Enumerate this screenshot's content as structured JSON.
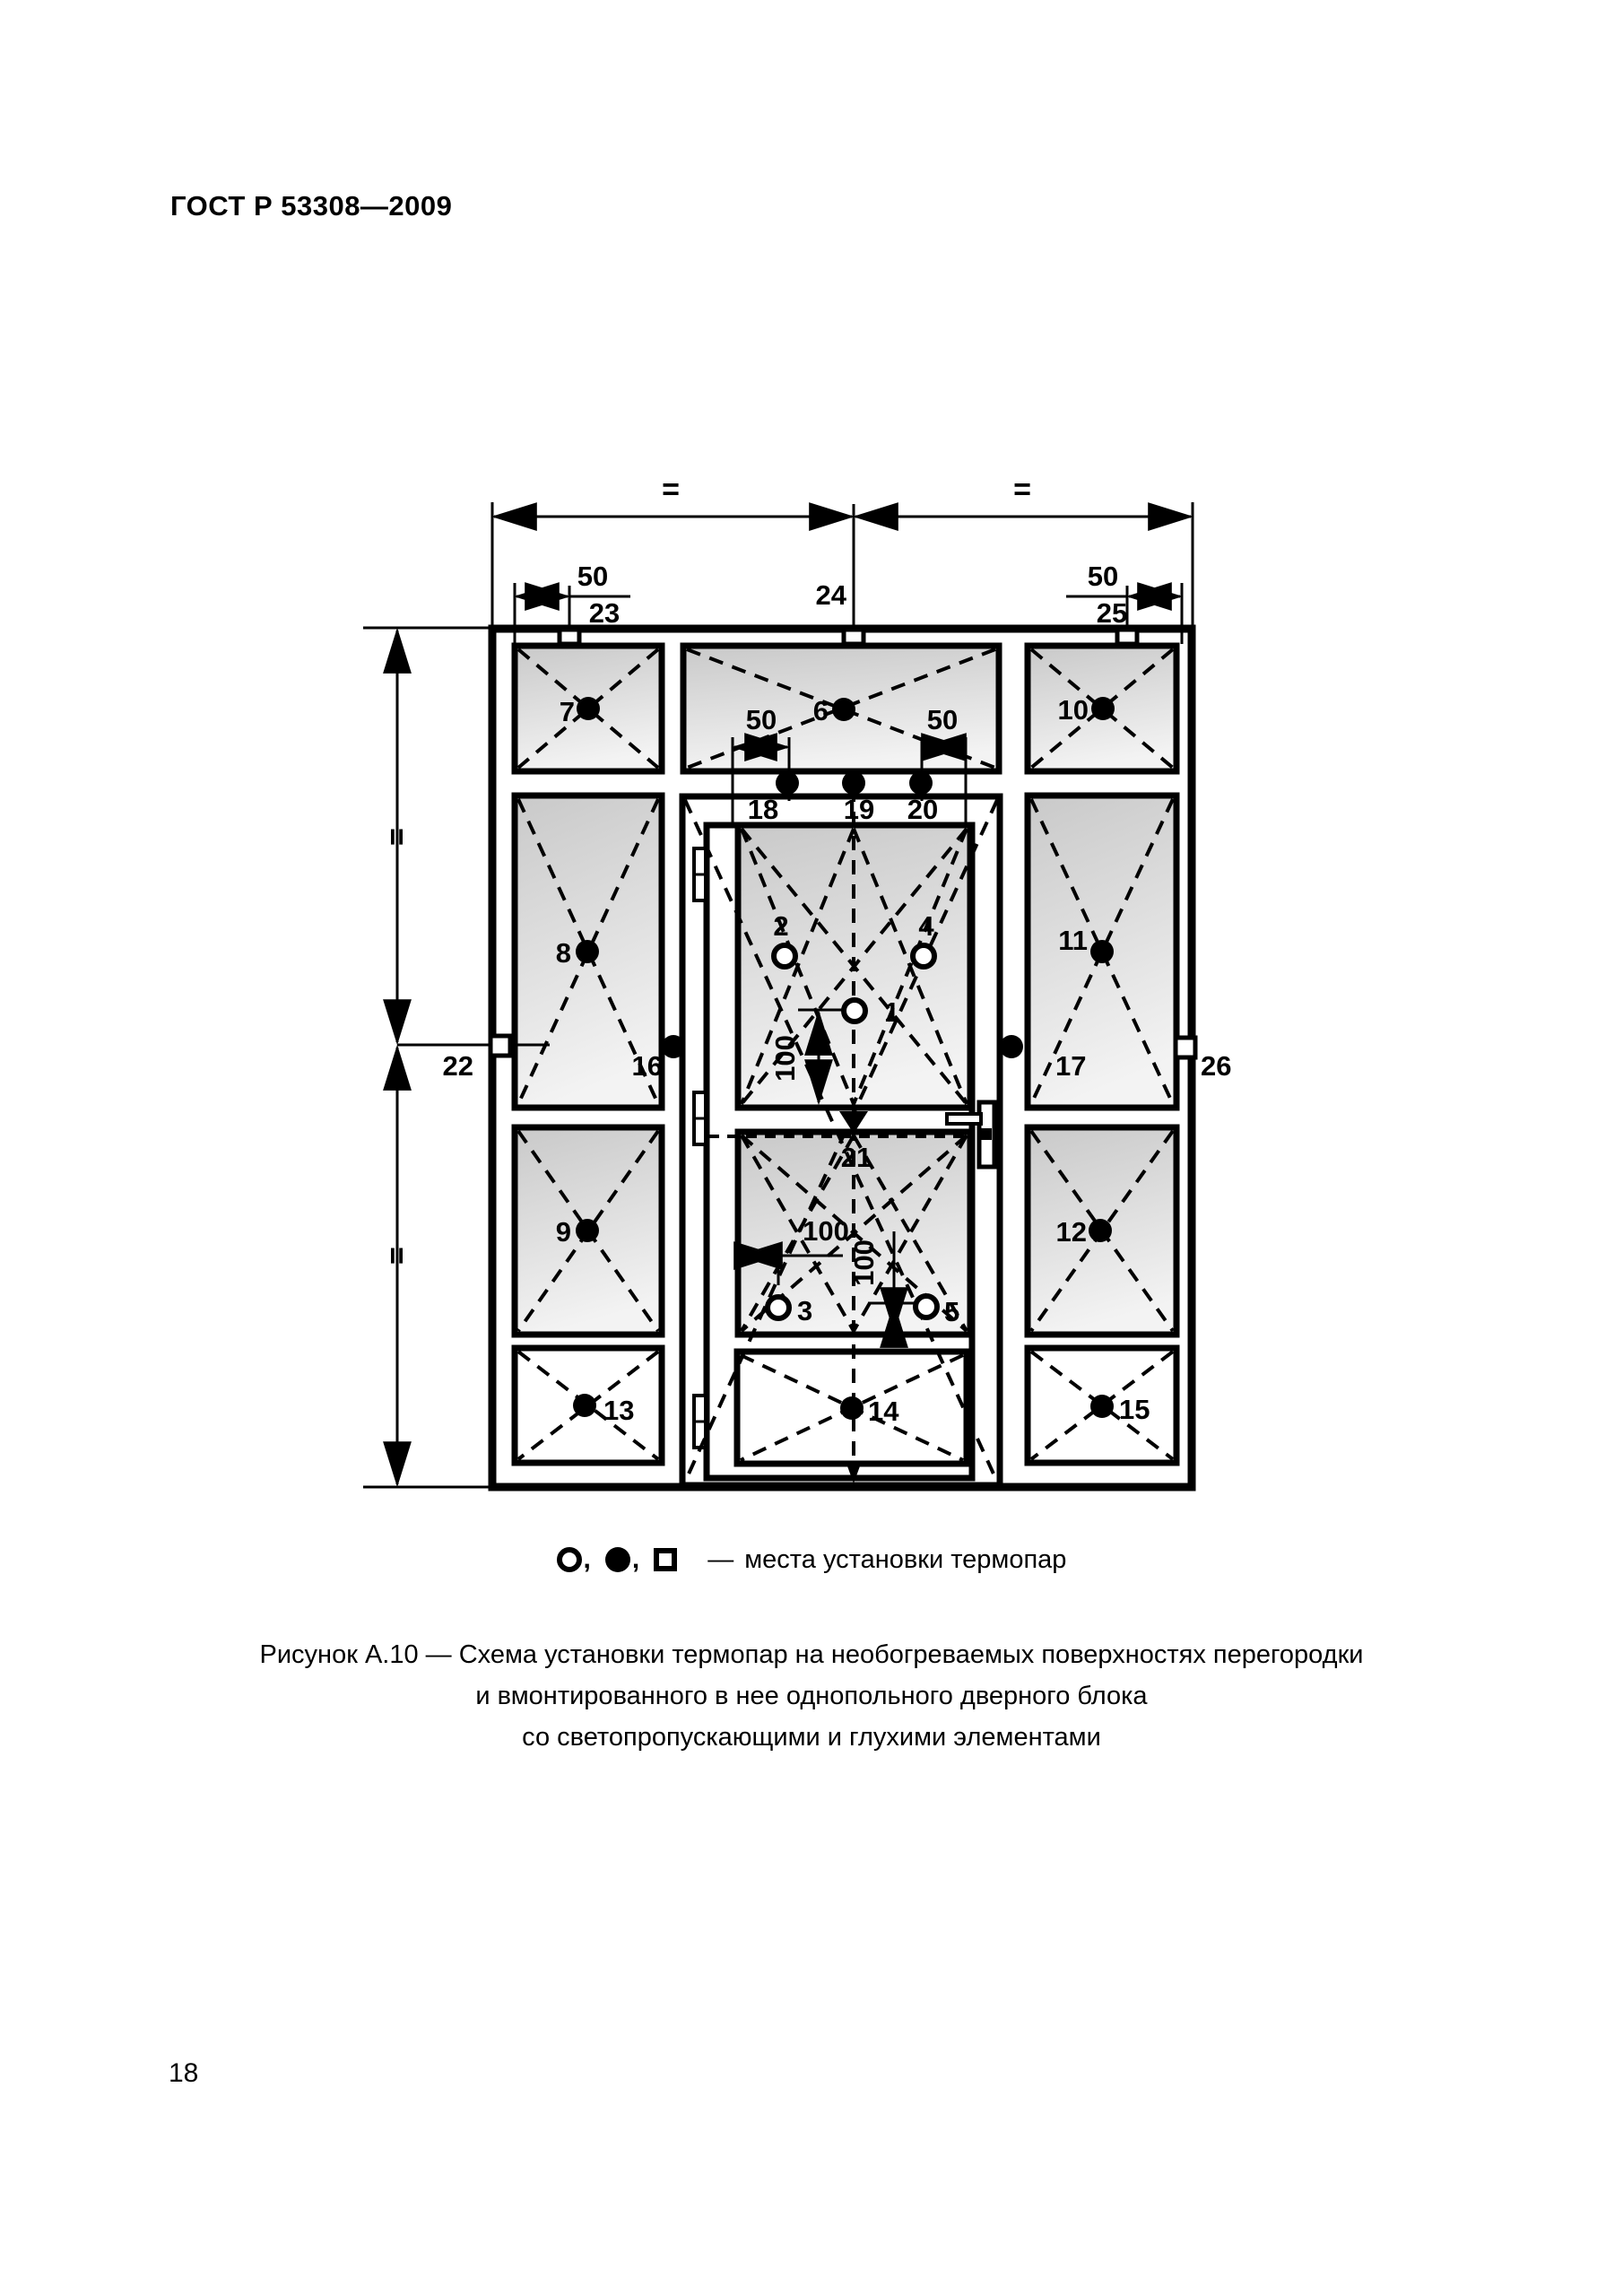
{
  "page": {
    "header": "ГОСТ Р 53308—2009",
    "page_number": "18"
  },
  "figure": {
    "points": {
      "p1": "1",
      "p2": "2",
      "p3": "3",
      "p4": "4",
      "p5": "5",
      "p6": "6",
      "p7": "7",
      "p8": "8",
      "p9": "9",
      "p10": "10",
      "p11": "11",
      "p12": "12",
      "p13": "13",
      "p14": "14",
      "p15": "15",
      "p16": "16",
      "p17": "17",
      "p18": "18",
      "p19": "19",
      "p20": "20",
      "p21": "21",
      "p22": "22",
      "p23": "23",
      "p24": "24",
      "p25": "25",
      "p26": "26"
    },
    "dims": {
      "fifty": "50",
      "hundred": "100"
    },
    "equal_mark": "=",
    "legend": {
      "comma": ",",
      "dash": "—",
      "text": "места установки термопар"
    },
    "caption": {
      "line1": "Рисунок А.10 — Схема установки термопар на необогреваемых поверхностях перегородки",
      "line2": "и вмонтированного в нее однопольного дверного блока",
      "line3": "со светопропускающими и глухими элементами"
    }
  }
}
